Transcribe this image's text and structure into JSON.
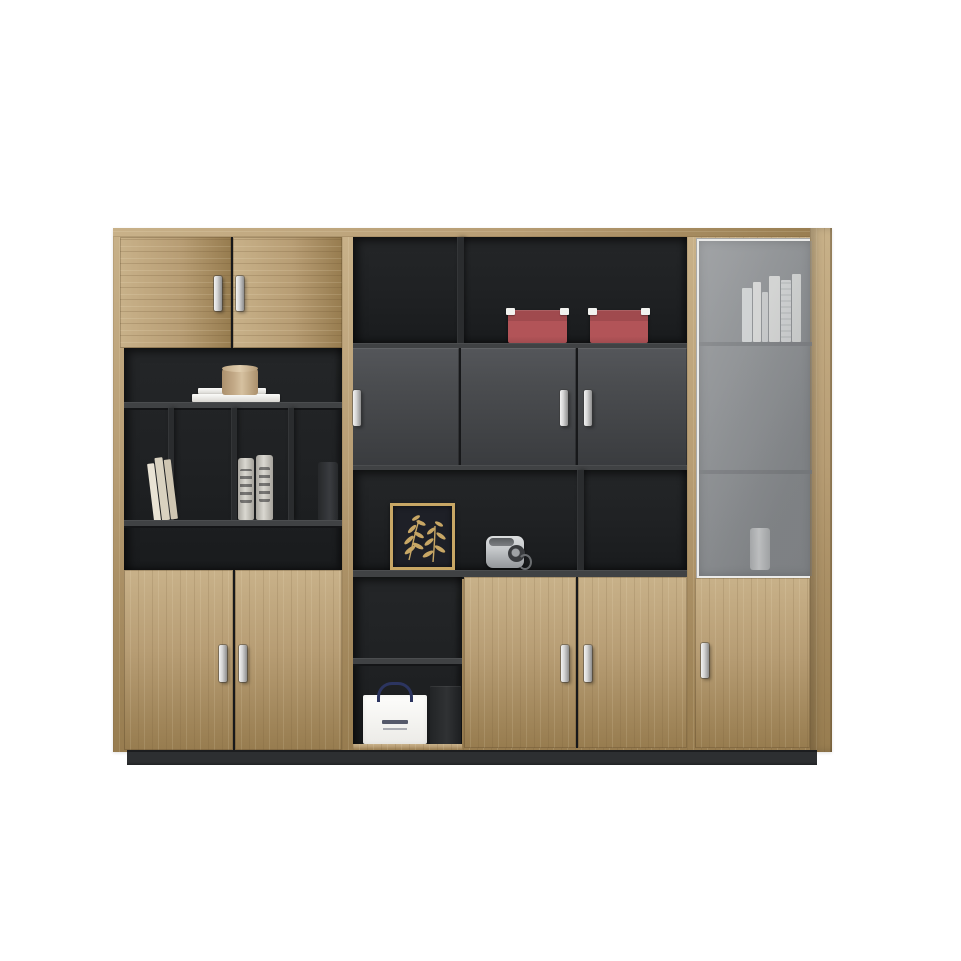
{
  "scene": {
    "title": "Modern office wall cabinet with oak doors, charcoal open shelving and glass display door",
    "background": "#ffffff"
  },
  "palette": {
    "wood": "#b79d74",
    "wood_light": "#c8b189",
    "wood_dark": "#977c4f",
    "interior": "#242628",
    "interior_deep": "#191b1d",
    "shelf": "#404244",
    "shelf_edge": "#141517",
    "divider": "#2a2c2e",
    "door_gray": "#4b4d50",
    "door_gray_dark": "#3a3c3f",
    "glass": "#8c8f92",
    "glass_frame": "#ebebe9",
    "plinth": "#2d2f31",
    "handle_light": "#f2f2f2",
    "handle_dark": "#8e8e8e",
    "red_box": "#b25458",
    "red_box_dark": "#a04a4e",
    "gold": "#c8a765",
    "artwork_bg": "#1e2027",
    "canister": "#c4ab89",
    "camera_silver": "#c6c9cb",
    "bag_handle": "#2c3560"
  },
  "cabinet": {
    "handle_count": 10,
    "handle_finish": "silver bar",
    "sections": {
      "left": {
        "top": "double oak doors",
        "middle": "open charcoal pigeonhole shelves",
        "bottom": "double oak doors"
      },
      "middle": {
        "top": "open shelf with two red storage boxes",
        "upper": "three charcoal hinged doors",
        "lower": "open display shelf with framed botanical art and camera",
        "bottom": "open niche with shopping bag beside double oak doors"
      },
      "right": {
        "top": "aluminium-framed glass door with white books and vase",
        "bottom": "single oak door"
      }
    }
  },
  "props": {
    "red_box": {
      "label": "red storage box",
      "color": "#b25458",
      "count": 2
    },
    "canister": {
      "label": "round wooden canister on white books",
      "color": "#c4ab89"
    },
    "white_books": {
      "label": "stack of white books"
    },
    "leaning_books": {
      "label": "leaning cream books"
    },
    "vases": {
      "label": "pair of printed ceramic vases"
    },
    "dark_bottle": {
      "label": "dark vase"
    },
    "artwork": {
      "label": "gold framed botanical artwork",
      "frame_color": "#c8a765"
    },
    "camera": {
      "label": "silver compact camera",
      "color": "#c6c9cb"
    },
    "shopping_bag": {
      "label": "white shopping bag with navy rope handle"
    },
    "gift_box": {
      "label": "dark gift box"
    },
    "glass_books": {
      "label": "white books behind glass"
    },
    "glass_vase": {
      "label": "white vase behind glass"
    }
  }
}
